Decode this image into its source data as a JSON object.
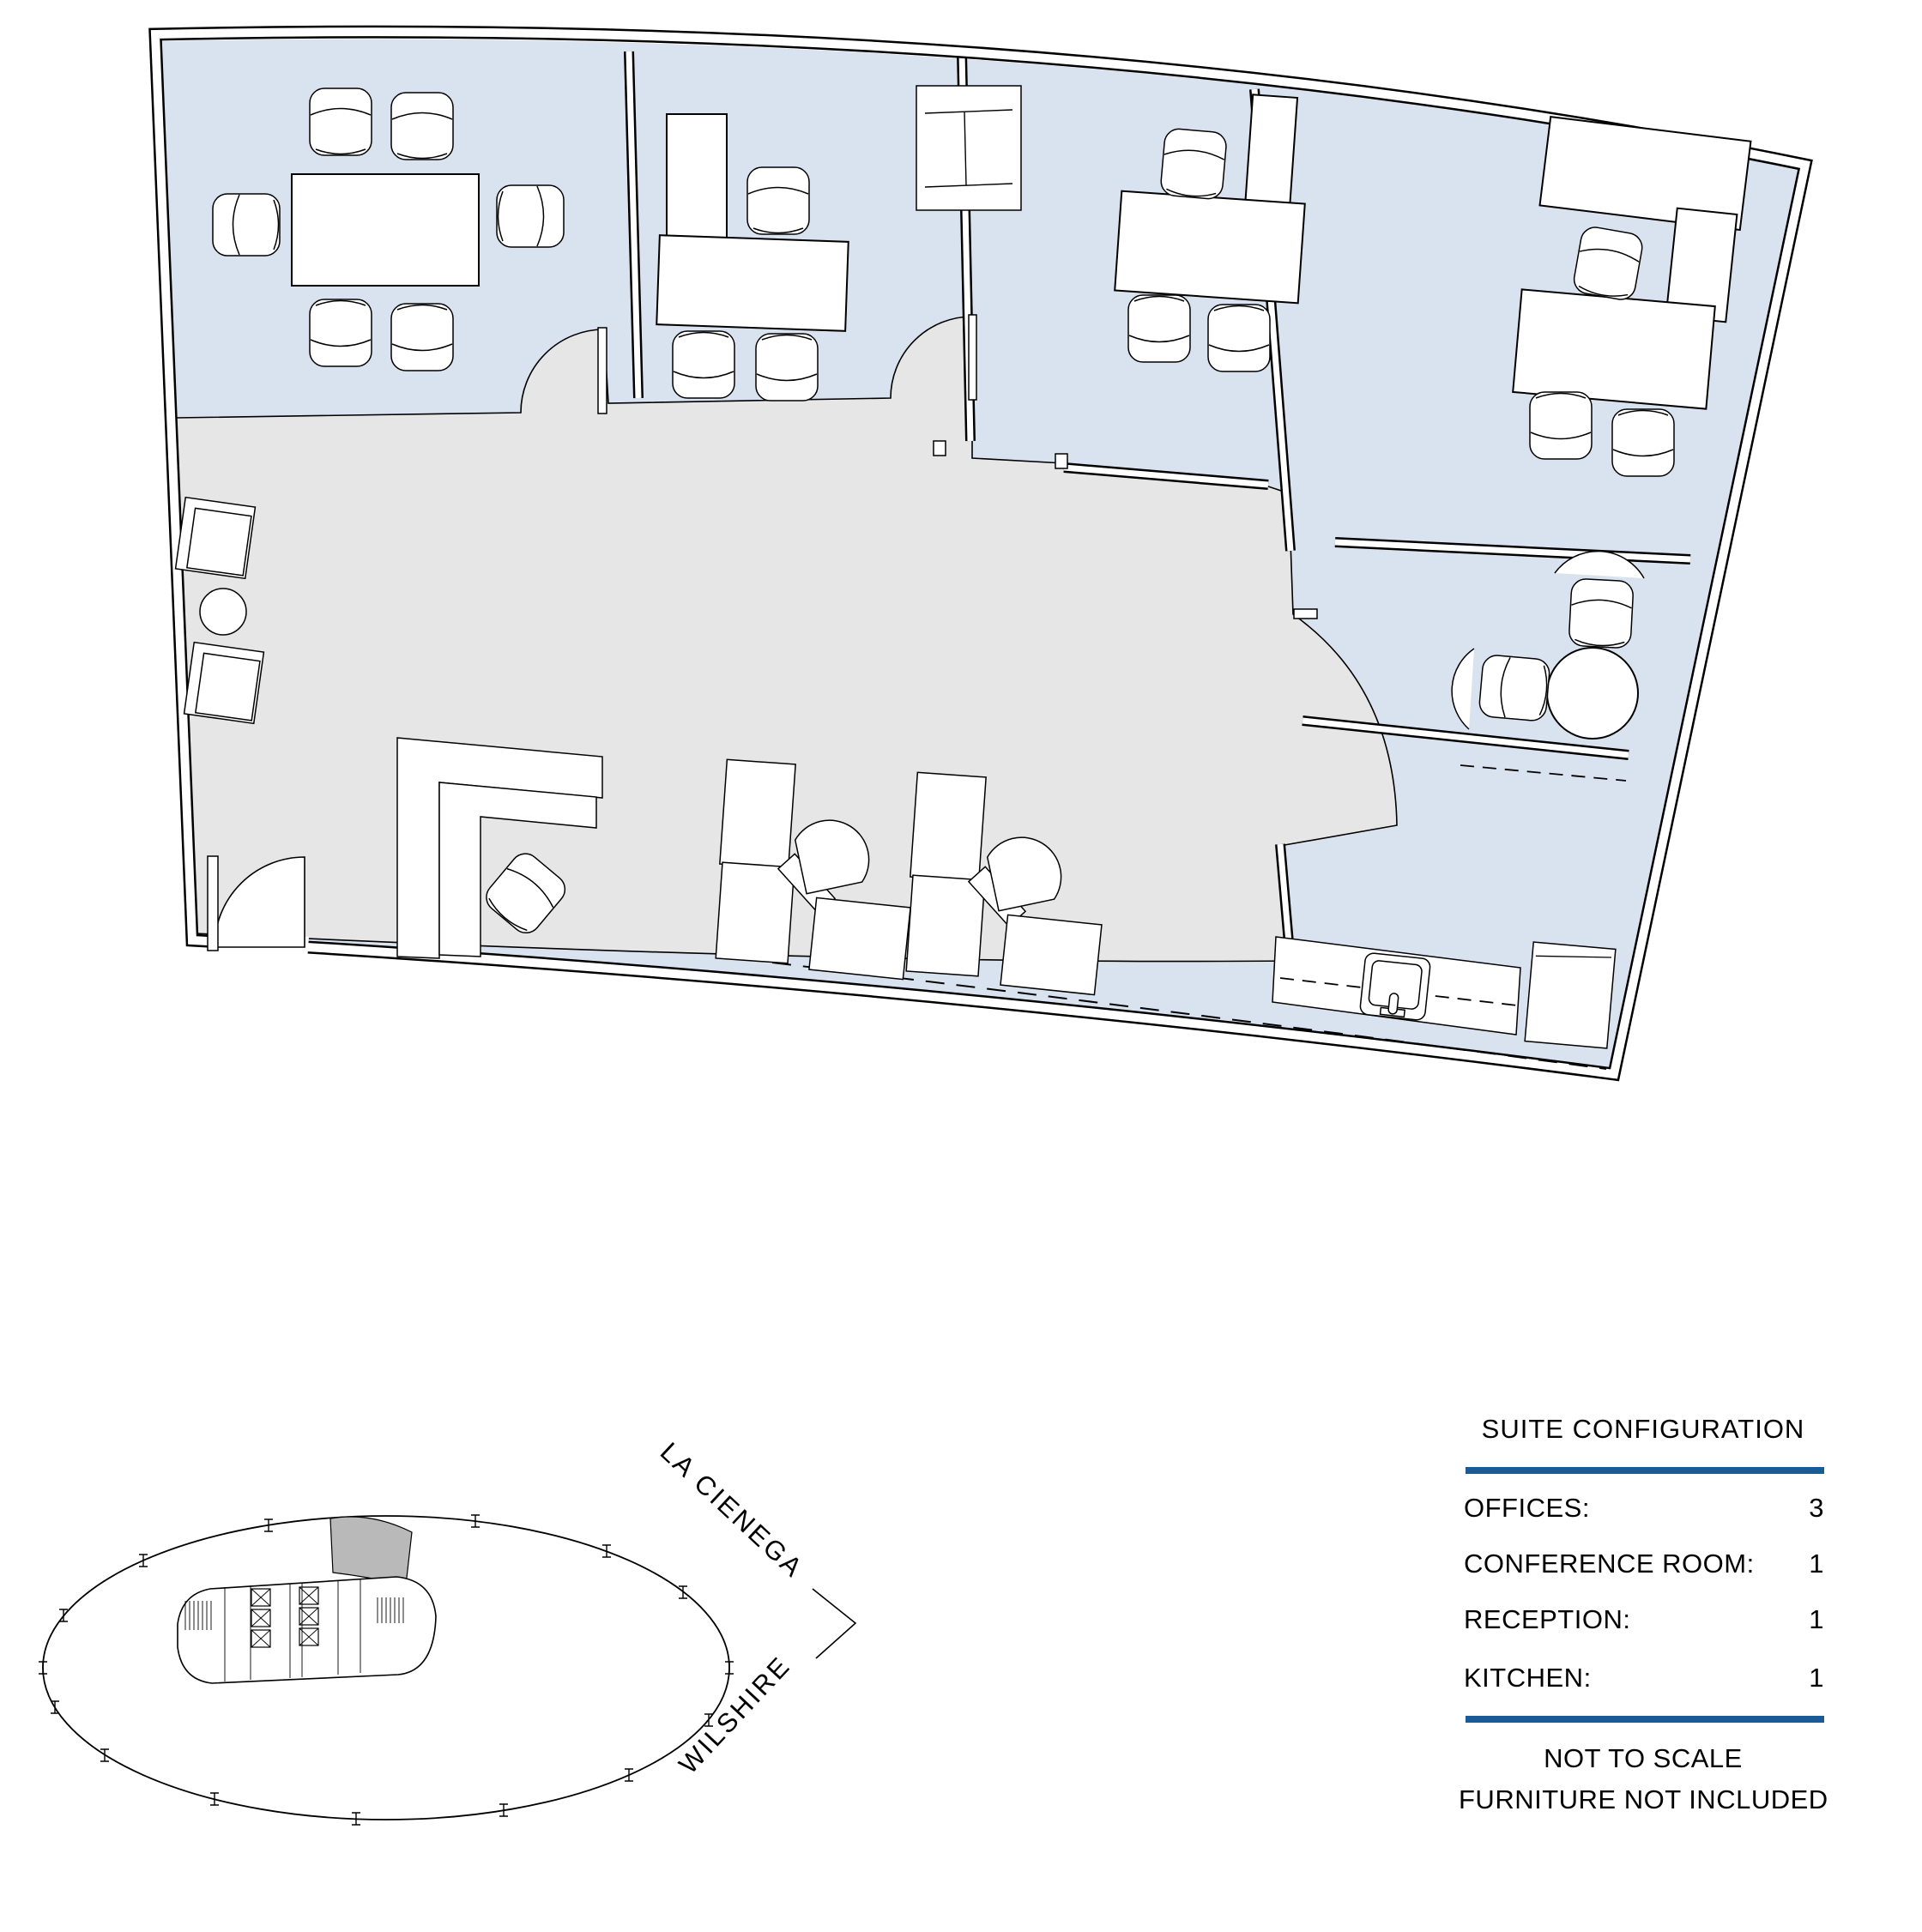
{
  "colors": {
    "room_fill": "#d9e2ef",
    "lobby_fill": "#e6e6e6",
    "keyplan_suite_fill": "#b9b9b9",
    "accent_blue": "#1a5a96",
    "wall_line": "#000000"
  },
  "key_plan": {
    "street_label_1": "LA CIENEGA",
    "street_label_2": "WILSHIRE"
  },
  "suite_configuration": {
    "title": "SUITE CONFIGURATION",
    "rows": [
      {
        "label": "OFFICES:",
        "value": "3"
      },
      {
        "label": "CONFERENCE ROOM:",
        "value": "1"
      },
      {
        "label": "RECEPTION:",
        "value": "1"
      },
      {
        "label": "KITCHEN:",
        "value": "1"
      }
    ],
    "note_1": "NOT TO SCALE",
    "note_2": "FURNITURE NOT INCLUDED"
  }
}
